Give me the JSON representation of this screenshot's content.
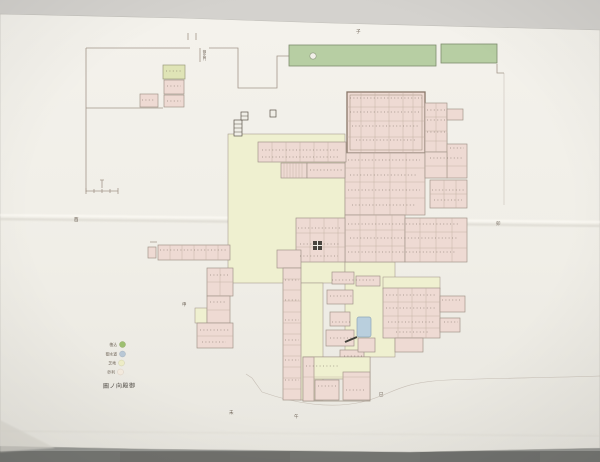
{
  "photo": {
    "backdrop": "#d4d2ce",
    "table": "#767773",
    "paper": "#f2f0e9"
  },
  "map": {
    "palette": {
      "line-sepia": "#a3968a",
      "building-pink": "#eedad3",
      "ground-yellow": "#eff0d0",
      "garden-green": "#b7cea3",
      "water-blue": "#b9cfdd",
      "ink-dark": "#55504a"
    },
    "title": "圖ノ向殿御",
    "gate_label": "御北門",
    "legend": {
      "items": [
        {
          "label": "植込",
          "color": "#9dbf70"
        },
        {
          "label": "御水道",
          "color": "#b8c7d5"
        },
        {
          "label": "芝地",
          "color": "#edecc6"
        },
        {
          "label": "砂利",
          "color": "#f3eade"
        }
      ]
    },
    "direction_marks": {
      "m1": "酉",
      "m2": "子",
      "m3": "未",
      "m4": "午",
      "m5": "巳",
      "m6": "卯",
      "m7": "申"
    }
  }
}
